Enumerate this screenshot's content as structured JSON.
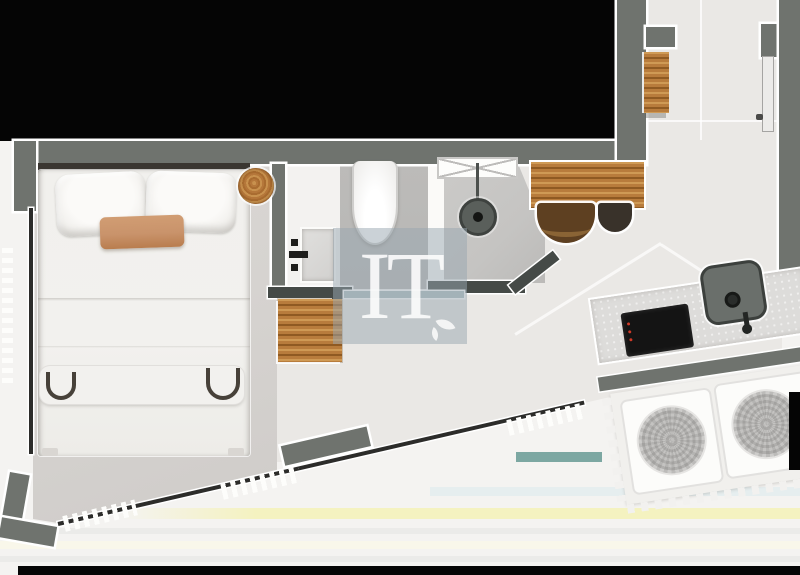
{
  "watermark": {
    "text": "IT",
    "icon": "leaf-icon"
  },
  "theme": {
    "colors": {
      "black": "#050505",
      "wall": "#6f736e",
      "wall_dark": "#454a47",
      "glass": "#2c2c2a",
      "wood": "#b87c3c",
      "wood_light": "#cf9a55",
      "wood_dark": "#8f5a22",
      "floor_tile": "#eae8e5",
      "floor_bedroom": "#d6d3d0",
      "floor_exterior": "#f4f3f1",
      "bath_gray": "#b8b7b5",
      "shower_gray": "#c5c4c2",
      "bath_white": "#f3f2f0",
      "bed_white": "#f2f1ee",
      "accent_cushion": "#c9936b",
      "counter": "#dddcda",
      "cooktop": "#141414",
      "red_indicator": "#cf3a28",
      "sink": "#6a6f6b",
      "teal_band": "#7ca7a2",
      "band_yellow": "#f4f2c0",
      "band_blue": "#e3ecee",
      "band_gray": "#ebebe9",
      "band_cream": "#f9f7ea",
      "chair_brown": "#5e4021",
      "chair_dark": "#39322a",
      "watermark_bg": "rgba(151,166,176,0.5)",
      "watermark_text": "rgba(252,252,252,0.9)"
    }
  }
}
